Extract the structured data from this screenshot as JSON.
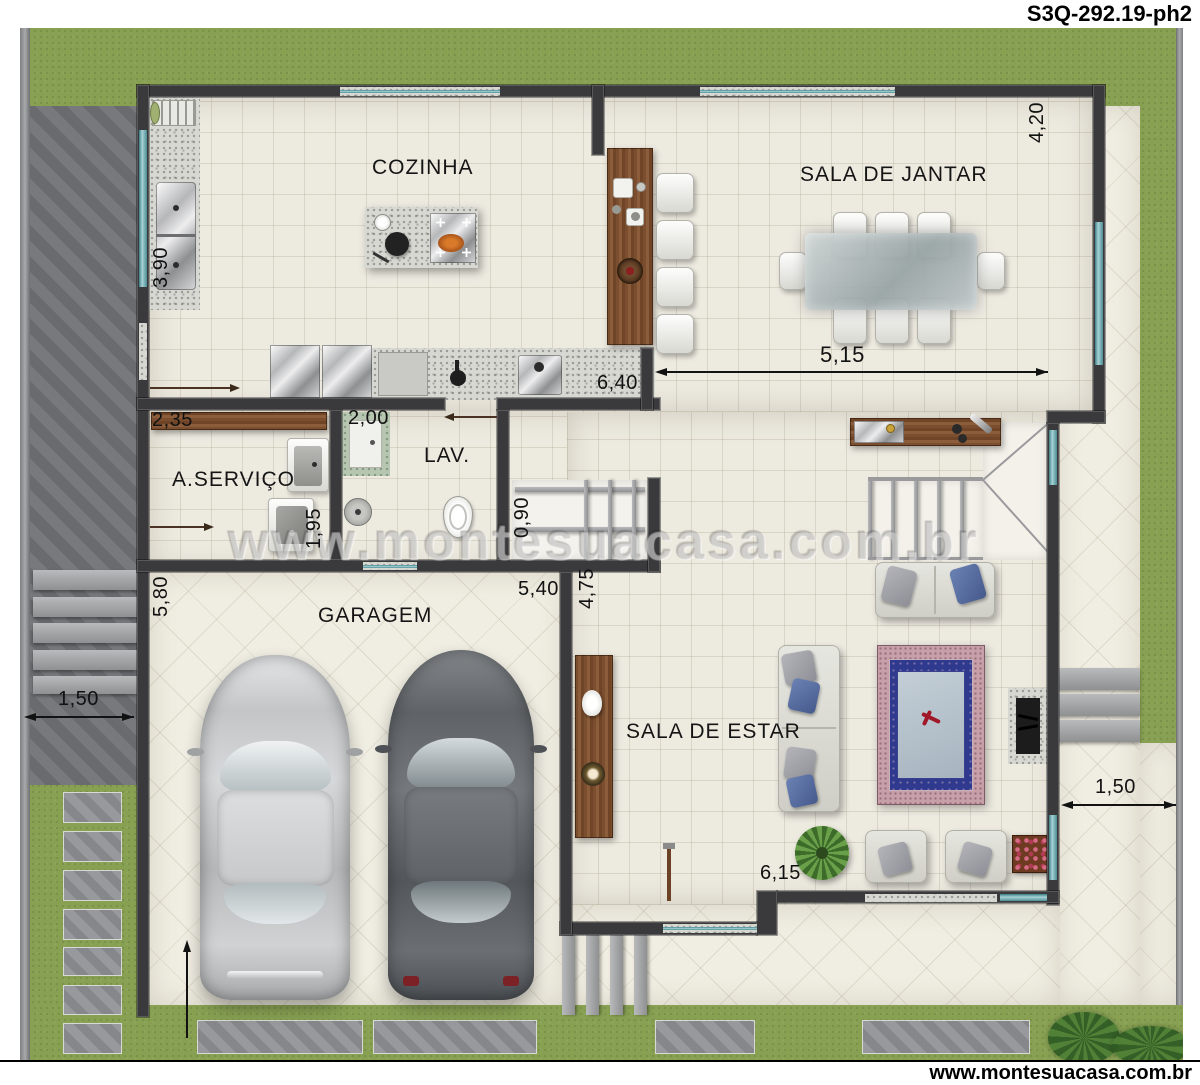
{
  "header": {
    "title": "S3Q-292.19-ph2"
  },
  "footer": {
    "website": "www.montesuacasa.com.br"
  },
  "watermark": {
    "text": "www.montesuacasa.com.br"
  },
  "rooms": {
    "cozinha": "COZINHA",
    "jantar": "SALA DE JANTAR",
    "servico": "A.SERVIÇO",
    "lav": "LAV.",
    "garagem": "GARAGEM",
    "estar": "SALA DE ESTAR"
  },
  "dims": {
    "d420": "4,20",
    "d390": "3,90",
    "d515": "5,15",
    "d640": "6,40",
    "d235": "2,35",
    "d200": "2,00",
    "d195": "1,95",
    "d090": "0,90",
    "d580": "5,80",
    "d540": "5,40",
    "d475": "4,75",
    "d615": "6,15",
    "d150_left": "1,50",
    "d150_right": "1,50"
  },
  "colors": {
    "wall": "#3a3a3c",
    "grass": "#87a052",
    "paving": "#6f7174",
    "floor_tile": "#edeae0",
    "floor_diamond": "#f0ede2",
    "granite": "#d8d8d3",
    "window_glass": "#6fa9ad",
    "wood": "#7b5233",
    "steel": "#c9cacc",
    "sofa": "#d9d9d1",
    "cushion_blue": "#5b74a8",
    "rug_border": "#c79fa8",
    "rug_field": "#2f3a8f",
    "rug_center": "#b9c5cd"
  }
}
